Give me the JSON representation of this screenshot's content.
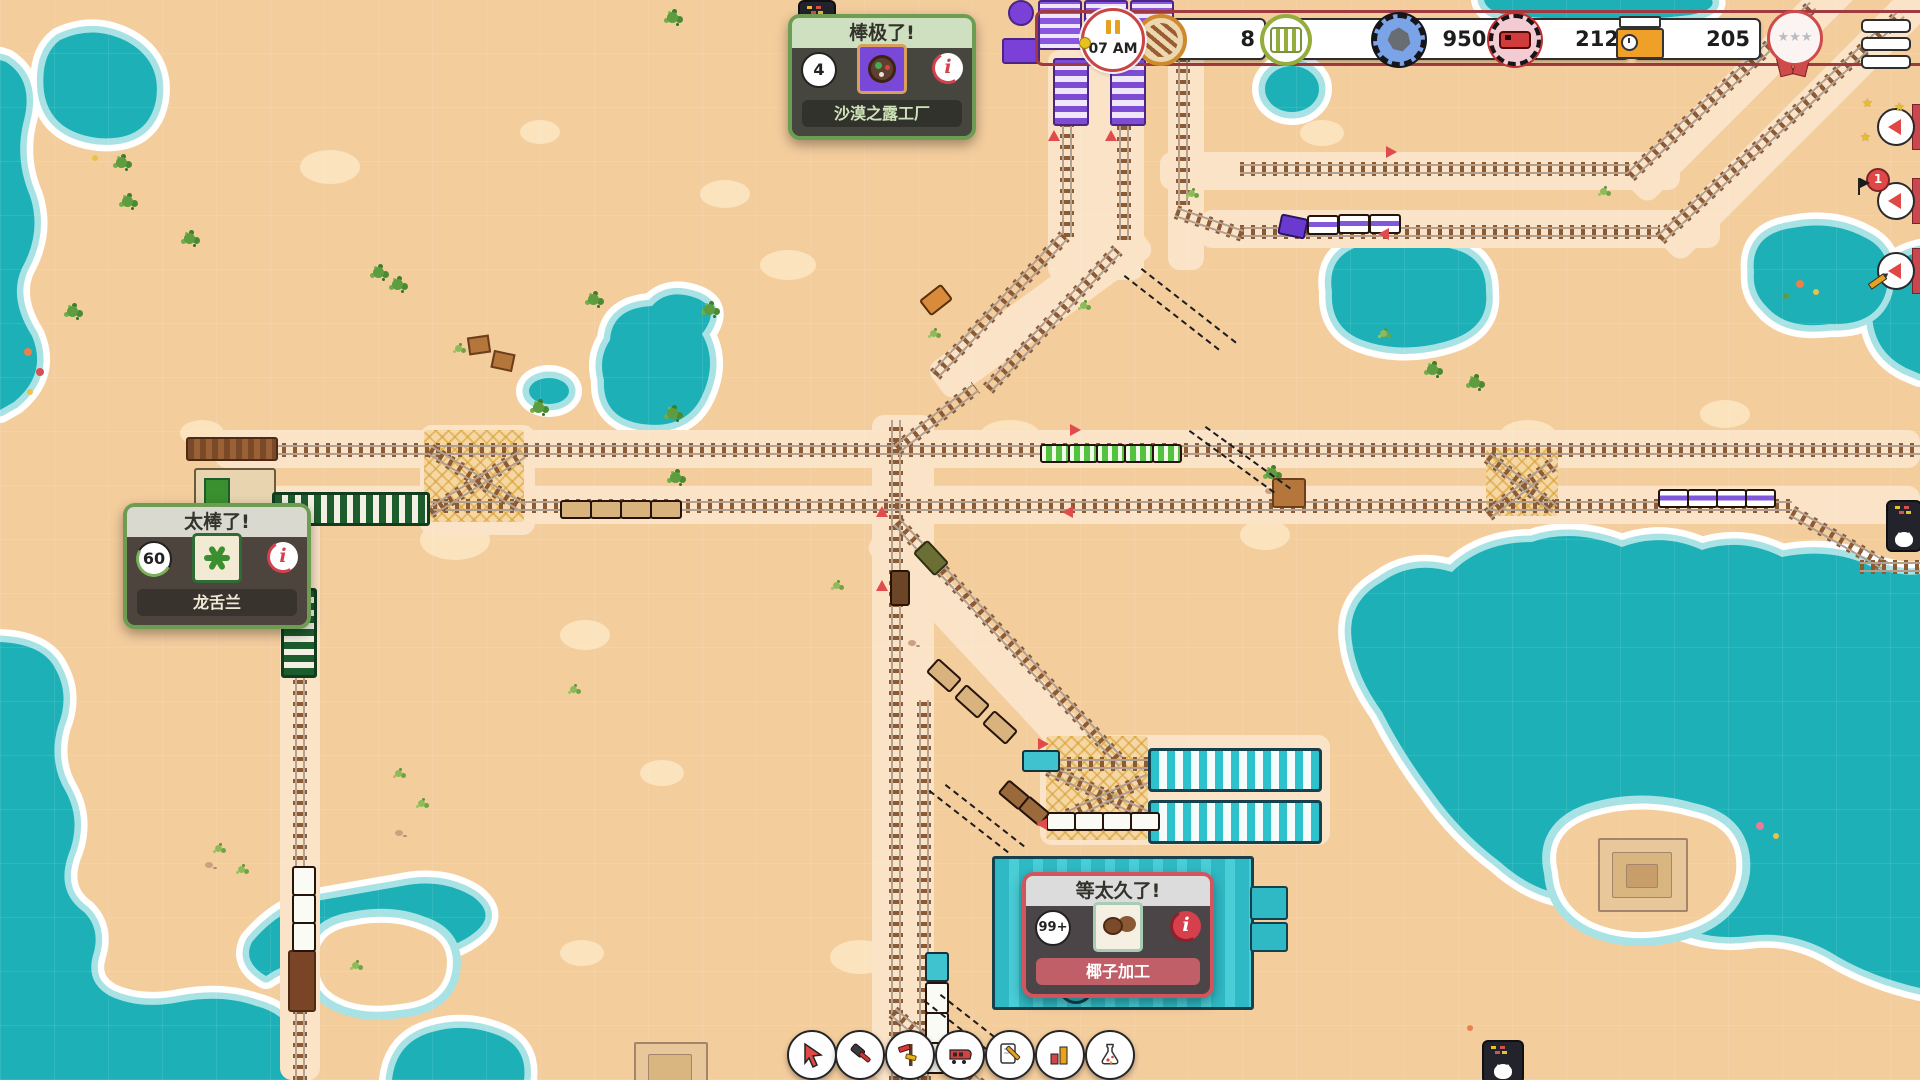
{
  "hud": {
    "clock": {
      "time": "07 AM"
    },
    "resources": [
      {
        "id": "track-parts",
        "icon": "sleeper-coin-icon",
        "value": "8"
      },
      {
        "id": "wagons",
        "icon": "green-wagon-coin-icon",
        "value": "1"
      },
      {
        "id": "stone",
        "icon": "blue-rock-coin-icon",
        "value": "9505"
      },
      {
        "id": "locomotives",
        "icon": "red-train-coin-icon",
        "value": "212"
      },
      {
        "id": "schedule",
        "icon": "orange-sign-clock-icon",
        "value": "205"
      }
    ],
    "medal": {
      "icon": "rosette-stars-medal",
      "stars": "★★★"
    },
    "menu": {
      "icon": "hamburger-icon"
    }
  },
  "popups": [
    {
      "title": "棒极了!",
      "count": "4",
      "label": "沙漠之露工厂",
      "mood": "positive",
      "item": "desert-dew"
    },
    {
      "title": "太棒了!",
      "count": "60",
      "label": "龙舌兰",
      "mood": "positive",
      "item": "agave"
    },
    {
      "title": "等太久了!",
      "count": "99+",
      "label": "椰子加工",
      "mood": "negative",
      "item": "coconut"
    }
  ],
  "edge_alerts": [
    {
      "decoration": "stars",
      "badge": ""
    },
    {
      "decoration": "flag",
      "badge": "1"
    },
    {
      "decoration": "pencil",
      "badge": ""
    }
  ],
  "toolbar": [
    {
      "id": "select-tool"
    },
    {
      "id": "build-tool"
    },
    {
      "id": "signal-tool"
    },
    {
      "id": "train-tool"
    },
    {
      "id": "orders-tool"
    },
    {
      "id": "stats-tool"
    },
    {
      "id": "research-tool"
    }
  ],
  "glyphs": {
    "info": "i",
    "star": "★"
  },
  "colors": {
    "sand": "#f4cd9d",
    "water": "#1db0b6",
    "water_rim": "#a9e2e4",
    "foam": "#ffffff",
    "track_sleeper": "#8d5a36",
    "accent_red": "#e14b4b",
    "bar_border": "#9e3a40",
    "popup_green": "#6d9d52",
    "popup_red": "#d4545e",
    "platform_teal": "#2ec2cc",
    "platform_green": "#1d5c2d",
    "platform_purple": "#7e4bd3"
  }
}
